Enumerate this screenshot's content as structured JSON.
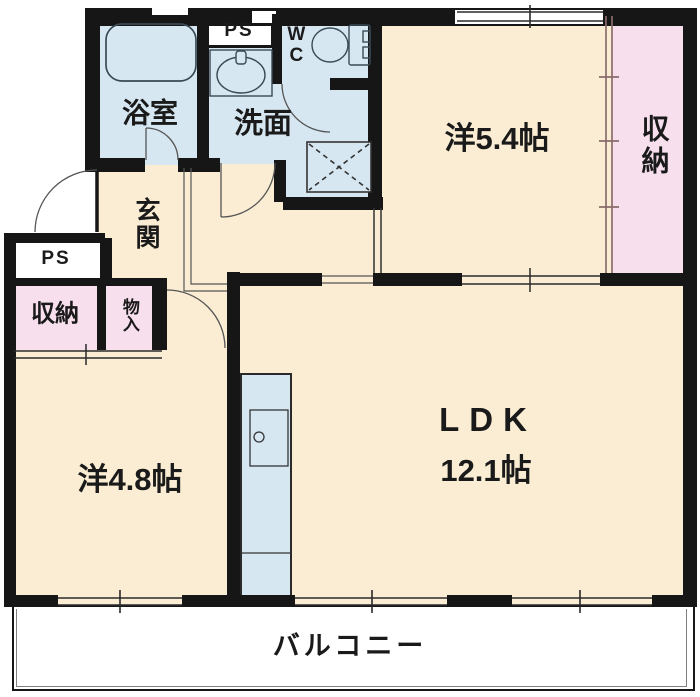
{
  "colors": {
    "room_floor": "#FAEDD3",
    "wet_area_floor": "#D6E7F1",
    "closet_pink": "#F7DFED",
    "wall_black": "#161616",
    "sliding_door_brown": "#8A6C6C"
  },
  "rooms": {
    "bathroom": {
      "label": "浴室"
    },
    "pipe_space_top": {
      "label": "PS"
    },
    "wc": {
      "label": "WC"
    },
    "washroom": {
      "label": "洗面"
    },
    "western_room_5_4": {
      "label": "洋5.4帖"
    },
    "closet_right": {
      "label": "収納"
    },
    "entrance": {
      "label": "玄関"
    },
    "pipe_space_left": {
      "label": "PS"
    },
    "closet_left": {
      "label": "収納"
    },
    "storage": {
      "label": "物入"
    },
    "western_room_4_8": {
      "label": "洋4.8帖"
    },
    "ldk": {
      "label": "LDK",
      "size": "12.1帖"
    },
    "balcony": {
      "label": "バルコニー"
    }
  },
  "icons": {
    "bathtub": "bathtub-icon",
    "toilet": "toilet-icon",
    "washbasin": "washbasin-icon",
    "washer_pan": "washing-machine-pan-icon",
    "kitchen_sink": "kitchen-sink-icon"
  }
}
